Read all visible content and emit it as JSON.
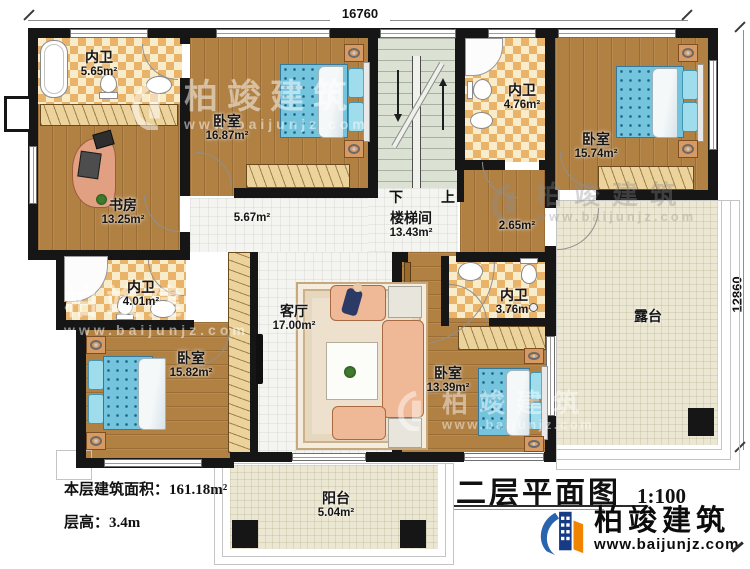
{
  "dimensions": {
    "top": "16760",
    "right": "12860"
  },
  "rooms": [
    {
      "name": "内卫",
      "area": "5.65m²"
    },
    {
      "name": "书房",
      "area": "13.25m²"
    },
    {
      "name": "卧室",
      "area": "16.87m²"
    },
    {
      "name": "楼梯间",
      "area": "13.43m²"
    },
    {
      "name": "内卫",
      "area": "4.76m²"
    },
    {
      "name": "卧室",
      "area": "15.74m²"
    },
    {
      "name": "",
      "area": "5.67m²"
    },
    {
      "name": "",
      "area": "2.65m²"
    },
    {
      "name": "内卫",
      "area": "4.01m²"
    },
    {
      "name": "卧室",
      "area": "15.82m²"
    },
    {
      "name": "客厅",
      "area": "17.00m²"
    },
    {
      "name": "内卫",
      "area": "3.76m²"
    },
    {
      "name": "卧室",
      "area": "13.39m²"
    },
    {
      "name": "露台",
      "area": ""
    },
    {
      "name": "阳台",
      "area": "5.04m²"
    }
  ],
  "stairs": {
    "down_label": "下",
    "up_label": "上"
  },
  "info": {
    "area_line": "本层建筑面积：161.18m²",
    "height_line": "层高：3.4m"
  },
  "title": {
    "text": "二层平面图",
    "scale": "1:100"
  },
  "brand": {
    "name": "柏竣建筑",
    "url": "www.baijunjz.com"
  },
  "watermark": {
    "name": "柏竣建筑",
    "url": "www.baijunjz.com"
  },
  "colors": {
    "wall": "#161616",
    "wood_floor": "#b18144",
    "tile_accent": "#e9b469",
    "bed": "#74c4de",
    "terrace": "#ebe7d2",
    "brand_blue": "#2a64ae",
    "brand_dark_blue": "#173a85",
    "brand_orange": "#f08300"
  }
}
